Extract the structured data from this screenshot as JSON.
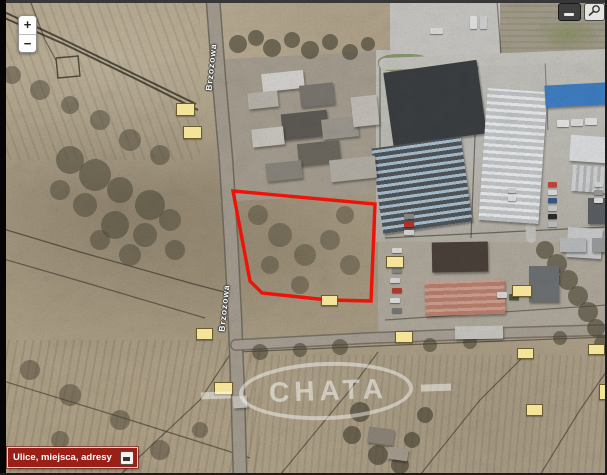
{
  "controls": {
    "zoom_in": "+",
    "zoom_out": "−"
  },
  "search": {
    "placeholder": "Ulice, miejsca, adresy"
  },
  "watermark": {
    "text": "CHATA"
  },
  "street_labels": [
    {
      "text": "Brzozowa"
    },
    {
      "text": "Brzozowa"
    }
  ],
  "map": {
    "selection_color": "#ee1208",
    "selection_polygon": [
      [
        233,
        191
      ],
      [
        375,
        204
      ],
      [
        371,
        301
      ],
      [
        328,
        300
      ],
      [
        262,
        293
      ],
      [
        250,
        281
      ]
    ],
    "marker_style": {
      "bg": "#f3e49a",
      "border": "#6b5d2e"
    },
    "markers": [
      {
        "x": 176,
        "y": 103,
        "w": 17,
        "h": 11
      },
      {
        "x": 183,
        "y": 126,
        "w": 17,
        "h": 11
      },
      {
        "x": 386,
        "y": 256,
        "w": 16,
        "h": 10
      },
      {
        "x": 321,
        "y": 295,
        "w": 15,
        "h": 9
      },
      {
        "x": 395,
        "y": 331,
        "w": 16,
        "h": 10
      },
      {
        "x": 512,
        "y": 285,
        "w": 18,
        "h": 10
      },
      {
        "x": 517,
        "y": 348,
        "w": 15,
        "h": 9
      },
      {
        "x": 526,
        "y": 404,
        "w": 15,
        "h": 10
      },
      {
        "x": 588,
        "y": 344,
        "w": 15,
        "h": 9
      },
      {
        "x": 599,
        "y": 384,
        "w": 8,
        "h": 14
      },
      {
        "x": 214,
        "y": 382,
        "w": 17,
        "h": 11
      },
      {
        "x": 196,
        "y": 328,
        "w": 15,
        "h": 10
      }
    ],
    "buildings": [
      {
        "x": 388,
        "y": 66,
        "w": 94,
        "h": 74,
        "rot": -8,
        "c": "#3b3e41"
      },
      {
        "x": 377,
        "y": 142,
        "w": 90,
        "h": 86,
        "rot": -8,
        "c": "#50555a",
        "s": "#a8bfcf",
        "a": 0
      },
      {
        "x": 483,
        "y": 90,
        "w": 60,
        "h": 132,
        "rot": 4,
        "c": "#c2c5c7",
        "s": "#e9ebec",
        "a": 0
      },
      {
        "x": 545,
        "y": 84,
        "w": 62,
        "h": 22,
        "rot": -3,
        "c": "#3e7ec3"
      },
      {
        "x": 570,
        "y": 136,
        "w": 37,
        "h": 26,
        "rot": 4,
        "c": "#dcdedf"
      },
      {
        "x": 572,
        "y": 166,
        "w": 35,
        "h": 26,
        "rot": 4,
        "c": "#d0d2d3",
        "s": "#b4b6b7",
        "a": 90
      },
      {
        "x": 588,
        "y": 198,
        "w": 19,
        "h": 26,
        "rot": 0,
        "c": "#5c6064"
      },
      {
        "x": 567,
        "y": 228,
        "w": 35,
        "h": 30,
        "rot": 4,
        "c": "#c9cbcc"
      },
      {
        "x": 262,
        "y": 72,
        "w": 42,
        "h": 18,
        "rot": -6,
        "c": "#d6d3cf"
      },
      {
        "x": 300,
        "y": 84,
        "w": 34,
        "h": 22,
        "rot": -6,
        "c": "#7b7670"
      },
      {
        "x": 248,
        "y": 92,
        "w": 30,
        "h": 16,
        "rot": -6,
        "c": "#b9b4ac"
      },
      {
        "x": 282,
        "y": 112,
        "w": 46,
        "h": 26,
        "rot": -6,
        "c": "#5e5a54"
      },
      {
        "x": 322,
        "y": 118,
        "w": 36,
        "h": 20,
        "rot": -6,
        "c": "#9d9890"
      },
      {
        "x": 252,
        "y": 128,
        "w": 32,
        "h": 18,
        "rot": -6,
        "c": "#cac6bf"
      },
      {
        "x": 298,
        "y": 142,
        "w": 42,
        "h": 22,
        "rot": -6,
        "c": "#6c6860"
      },
      {
        "x": 330,
        "y": 158,
        "w": 46,
        "h": 22,
        "rot": -6,
        "c": "#b3afa7"
      },
      {
        "x": 266,
        "y": 162,
        "w": 36,
        "h": 18,
        "rot": -6,
        "c": "#8a867d"
      },
      {
        "x": 352,
        "y": 96,
        "w": 26,
        "h": 30,
        "rot": -6,
        "c": "#c3bfb8"
      },
      {
        "x": 432,
        "y": 242,
        "w": 56,
        "h": 30,
        "rot": -1,
        "c": "#4b403a"
      },
      {
        "x": 425,
        "y": 281,
        "w": 80,
        "h": 34,
        "rot": -2,
        "c": "#b97f6e",
        "s": "#cfa090",
        "a": 0
      },
      {
        "x": 529,
        "y": 266,
        "w": 30,
        "h": 36,
        "rot": 0,
        "c": "#6e7173"
      },
      {
        "x": 455,
        "y": 326,
        "w": 48,
        "h": 13,
        "rot": -1,
        "c": "#c9c7c1"
      },
      {
        "x": 560,
        "y": 238,
        "w": 26,
        "h": 14,
        "rot": 0,
        "c": "#b9bbbc"
      },
      {
        "x": 592,
        "y": 238,
        "w": 15,
        "h": 14,
        "rot": 0,
        "c": "#9a9c9d"
      },
      {
        "x": 368,
        "y": 428,
        "w": 26,
        "h": 16,
        "rot": 8,
        "c": "#8d8579"
      },
      {
        "x": 388,
        "y": 448,
        "w": 20,
        "h": 12,
        "rot": 8,
        "c": "#a79e90"
      },
      {
        "x": 233,
        "y": 396,
        "w": 14,
        "h": 12,
        "rot": -4,
        "c": "#c5c2bb"
      }
    ],
    "cars": [
      {
        "x": 557,
        "y": 120,
        "w": 12,
        "h": 7,
        "c": "#e8e8e8"
      },
      {
        "x": 571,
        "y": 119,
        "w": 12,
        "h": 7,
        "c": "#dedede"
      },
      {
        "x": 585,
        "y": 118,
        "w": 12,
        "h": 7,
        "c": "#e2e2e2"
      },
      {
        "x": 548,
        "y": 182,
        "w": 9,
        "h": 5,
        "c": "#c8453a"
      },
      {
        "x": 548,
        "y": 190,
        "w": 9,
        "h": 5,
        "c": "#dddddd"
      },
      {
        "x": 548,
        "y": 198,
        "w": 9,
        "h": 5,
        "c": "#38588c"
      },
      {
        "x": 548,
        "y": 206,
        "w": 9,
        "h": 5,
        "c": "#cccccc"
      },
      {
        "x": 548,
        "y": 214,
        "w": 9,
        "h": 5,
        "c": "#2a2a2a"
      },
      {
        "x": 548,
        "y": 222,
        "w": 9,
        "h": 5,
        "c": "#bfbfbf"
      },
      {
        "x": 594,
        "y": 182,
        "w": 9,
        "h": 5,
        "c": "#d5d5d5"
      },
      {
        "x": 594,
        "y": 190,
        "w": 9,
        "h": 5,
        "c": "#9a9a9a"
      },
      {
        "x": 594,
        "y": 198,
        "w": 9,
        "h": 5,
        "c": "#e0e0e0"
      },
      {
        "x": 470,
        "y": 16,
        "w": 7,
        "h": 13,
        "c": "#e5e5e5"
      },
      {
        "x": 480,
        "y": 16,
        "w": 7,
        "h": 13,
        "c": "#d2d2d2"
      },
      {
        "x": 430,
        "y": 28,
        "w": 13,
        "h": 6,
        "c": "#dadada"
      },
      {
        "x": 404,
        "y": 214,
        "w": 10,
        "h": 5,
        "c": "#888888"
      },
      {
        "x": 404,
        "y": 222,
        "w": 10,
        "h": 5,
        "c": "#c03028"
      },
      {
        "x": 404,
        "y": 230,
        "w": 10,
        "h": 5,
        "c": "#d8d8d8"
      },
      {
        "x": 392,
        "y": 248,
        "w": 10,
        "h": 5,
        "c": "#dddddd"
      },
      {
        "x": 390,
        "y": 258,
        "w": 10,
        "h": 5,
        "c": "#c0c0c0"
      },
      {
        "x": 392,
        "y": 268,
        "w": 10,
        "h": 5,
        "c": "#8a8a8a"
      },
      {
        "x": 390,
        "y": 278,
        "w": 10,
        "h": 5,
        "c": "#d8d8d8"
      },
      {
        "x": 392,
        "y": 288,
        "w": 10,
        "h": 5,
        "c": "#b23a2e"
      },
      {
        "x": 390,
        "y": 298,
        "w": 10,
        "h": 5,
        "c": "#e0e0e0"
      },
      {
        "x": 392,
        "y": 308,
        "w": 10,
        "h": 5,
        "c": "#777777"
      },
      {
        "x": 508,
        "y": 188,
        "w": 8,
        "h": 5,
        "c": "#d0d0d0"
      },
      {
        "x": 508,
        "y": 196,
        "w": 8,
        "h": 5,
        "c": "#e4e4e4"
      },
      {
        "x": 497,
        "y": 292,
        "w": 10,
        "h": 6,
        "c": "#d8d8d8"
      },
      {
        "x": 509,
        "y": 294,
        "w": 10,
        "h": 6,
        "c": "#445d35"
      }
    ],
    "roads": [
      {
        "pts": "213,0 219,80 226,160 231,240 235,320 238,400 240,475",
        "w": 15,
        "c": "#6e675c",
        "o": 0.9
      },
      {
        "pts": "213,0 219,80 226,160 231,240 235,320 238,400 240,475",
        "w": 12,
        "c": "#a59d90",
        "o": 1
      },
      {
        "pts": "236,345 370,338 500,333 607,330",
        "w": 12,
        "c": "#6e675c",
        "o": 0.8
      },
      {
        "pts": "236,345 370,338 500,333 607,330",
        "w": 9,
        "c": "#a8a094",
        "o": 1
      },
      {
        "pts": "385,64 607,55",
        "w": 12,
        "c": "#c6c4be",
        "o": 1
      },
      {
        "pts": "524,62 528,150 531,238",
        "w": 10,
        "c": "#c4c2bc",
        "o": 1
      }
    ],
    "parcel_lines": [
      {
        "pts": "0,10 60,38 130,72 196,104",
        "w": 2,
        "o": 0.7
      },
      {
        "pts": "0,16 64,44 134,78 198,110",
        "w": 2,
        "o": 0.7
      },
      {
        "pts": "0,228 80,252 190,283 228,293",
        "w": 1.2,
        "o": 0.55
      },
      {
        "pts": "0,258 90,284 205,318",
        "w": 1.2,
        "o": 0.5
      },
      {
        "pts": "0,380 130,420 250,458",
        "w": 1.2,
        "o": 0.5
      },
      {
        "pts": "120,475 200,400 233,350",
        "w": 1.2,
        "o": 0.5
      },
      {
        "pts": "30,0 45,40 56,60",
        "w": 1.2,
        "o": 0.5
      },
      {
        "pts": "56,58 78,56 80,76 58,78 56,58",
        "w": 1.4,
        "o": 0.7
      },
      {
        "pts": "236,352 400,345 607,337",
        "w": 1.2,
        "o": 0.5
      },
      {
        "pts": "280,475 350,390 378,352",
        "w": 1.2,
        "o": 0.5
      },
      {
        "pts": "420,475 480,400 528,352",
        "w": 1.2,
        "o": 0.5
      },
      {
        "pts": "540,475 580,410 606,372",
        "w": 1.2,
        "o": 0.5
      },
      {
        "pts": "385,320 607,305",
        "w": 1.2,
        "o": 0.45
      },
      {
        "pts": "380,210 380,66",
        "w": 1.2,
        "o": 0.5
      },
      {
        "pts": "478,60 471,238",
        "w": 1.2,
        "o": 0.5
      },
      {
        "pts": "385,238 607,227",
        "w": 1.2,
        "o": 0.5
      },
      {
        "pts": "497,0 501,55",
        "w": 1.2,
        "o": 0.45
      },
      {
        "pts": "545,60 548,130",
        "w": 1,
        "o": 0.4
      }
    ],
    "trees": [
      {
        "x": 70,
        "y": 160,
        "r": 14,
        "c": "#4d4837",
        "o": 0.55
      },
      {
        "x": 95,
        "y": 175,
        "r": 16,
        "c": "#4d4837",
        "o": 0.55
      },
      {
        "x": 120,
        "y": 190,
        "r": 13,
        "c": "#4d4837",
        "o": 0.55
      },
      {
        "x": 150,
        "y": 205,
        "r": 15,
        "c": "#4d4837",
        "o": 0.55
      },
      {
        "x": 85,
        "y": 205,
        "r": 12,
        "c": "#4d4837",
        "o": 0.5
      },
      {
        "x": 115,
        "y": 225,
        "r": 14,
        "c": "#4d4837",
        "o": 0.55
      },
      {
        "x": 145,
        "y": 235,
        "r": 12,
        "c": "#4d4837",
        "o": 0.5
      },
      {
        "x": 170,
        "y": 220,
        "r": 11,
        "c": "#4d4837",
        "o": 0.5
      },
      {
        "x": 60,
        "y": 190,
        "r": 10,
        "c": "#4d4837",
        "o": 0.5
      },
      {
        "x": 175,
        "y": 250,
        "r": 10,
        "c": "#4d4837",
        "o": 0.5
      },
      {
        "x": 130,
        "y": 255,
        "r": 11,
        "c": "#4d4837",
        "o": 0.5
      },
      {
        "x": 100,
        "y": 240,
        "r": 10,
        "c": "#4d4837",
        "o": 0.5
      },
      {
        "x": 12,
        "y": 75,
        "r": 9,
        "c": "#4d4837",
        "o": 0.5
      },
      {
        "x": 40,
        "y": 90,
        "r": 10,
        "c": "#4d4837",
        "o": 0.5
      },
      {
        "x": 70,
        "y": 105,
        "r": 9,
        "c": "#4d4837",
        "o": 0.5
      },
      {
        "x": 100,
        "y": 120,
        "r": 10,
        "c": "#4d4837",
        "o": 0.5
      },
      {
        "x": 130,
        "y": 140,
        "r": 11,
        "c": "#4d4837",
        "o": 0.5
      },
      {
        "x": 160,
        "y": 155,
        "r": 10,
        "c": "#4d4837",
        "o": 0.5
      },
      {
        "x": 238,
        "y": 44,
        "r": 9,
        "c": "#43402f",
        "o": 0.6
      },
      {
        "x": 256,
        "y": 38,
        "r": 8,
        "c": "#43402f",
        "o": 0.6
      },
      {
        "x": 272,
        "y": 48,
        "r": 9,
        "c": "#43402f",
        "o": 0.6
      },
      {
        "x": 292,
        "y": 40,
        "r": 8,
        "c": "#43402f",
        "o": 0.6
      },
      {
        "x": 310,
        "y": 50,
        "r": 9,
        "c": "#43402f",
        "o": 0.6
      },
      {
        "x": 330,
        "y": 42,
        "r": 8,
        "c": "#43402f",
        "o": 0.6
      },
      {
        "x": 350,
        "y": 52,
        "r": 8,
        "c": "#43402f",
        "o": 0.6
      },
      {
        "x": 368,
        "y": 44,
        "r": 7,
        "c": "#43402f",
        "o": 0.6
      },
      {
        "x": 258,
        "y": 215,
        "r": 10,
        "c": "#56503e",
        "o": 0.5
      },
      {
        "x": 280,
        "y": 235,
        "r": 12,
        "c": "#56503e",
        "o": 0.5
      },
      {
        "x": 305,
        "y": 255,
        "r": 11,
        "c": "#56503e",
        "o": 0.5
      },
      {
        "x": 330,
        "y": 240,
        "r": 10,
        "c": "#56503e",
        "o": 0.5
      },
      {
        "x": 350,
        "y": 265,
        "r": 10,
        "c": "#56503e",
        "o": 0.5
      },
      {
        "x": 300,
        "y": 285,
        "r": 9,
        "c": "#56503e",
        "o": 0.5
      },
      {
        "x": 270,
        "y": 265,
        "r": 9,
        "c": "#56503e",
        "o": 0.5
      },
      {
        "x": 345,
        "y": 215,
        "r": 9,
        "c": "#56503e",
        "o": 0.5
      },
      {
        "x": 545,
        "y": 250,
        "r": 9,
        "c": "#474330",
        "o": 0.6
      },
      {
        "x": 557,
        "y": 264,
        "r": 10,
        "c": "#474330",
        "o": 0.6
      },
      {
        "x": 568,
        "y": 280,
        "r": 10,
        "c": "#474330",
        "o": 0.6
      },
      {
        "x": 578,
        "y": 296,
        "r": 10,
        "c": "#474330",
        "o": 0.6
      },
      {
        "x": 588,
        "y": 312,
        "r": 10,
        "c": "#474330",
        "o": 0.6
      },
      {
        "x": 596,
        "y": 328,
        "r": 9,
        "c": "#474330",
        "o": 0.6
      },
      {
        "x": 603,
        "y": 344,
        "r": 9,
        "c": "#474330",
        "o": 0.6
      },
      {
        "x": 260,
        "y": 352,
        "r": 8,
        "c": "#45412f",
        "o": 0.55
      },
      {
        "x": 300,
        "y": 350,
        "r": 7,
        "c": "#45412f",
        "o": 0.55
      },
      {
        "x": 340,
        "y": 347,
        "r": 8,
        "c": "#45412f",
        "o": 0.55
      },
      {
        "x": 430,
        "y": 345,
        "r": 7,
        "c": "#45412f",
        "o": 0.55
      },
      {
        "x": 470,
        "y": 342,
        "r": 7,
        "c": "#45412f",
        "o": 0.55
      },
      {
        "x": 560,
        "y": 338,
        "r": 7,
        "c": "#45412f",
        "o": 0.55
      },
      {
        "x": 30,
        "y": 370,
        "r": 10,
        "c": "#4d4837",
        "o": 0.5
      },
      {
        "x": 70,
        "y": 395,
        "r": 11,
        "c": "#4d4837",
        "o": 0.5
      },
      {
        "x": 120,
        "y": 420,
        "r": 10,
        "c": "#4d4837",
        "o": 0.5
      },
      {
        "x": 60,
        "y": 440,
        "r": 9,
        "c": "#4d4837",
        "o": 0.5
      },
      {
        "x": 160,
        "y": 450,
        "r": 10,
        "c": "#4d4837",
        "o": 0.5
      },
      {
        "x": 20,
        "y": 460,
        "r": 9,
        "c": "#4d4837",
        "o": 0.5
      },
      {
        "x": 200,
        "y": 430,
        "r": 8,
        "c": "#4d4837",
        "o": 0.5
      },
      {
        "x": 360,
        "y": 412,
        "r": 10,
        "c": "#3f3b2c",
        "o": 0.6
      },
      {
        "x": 352,
        "y": 435,
        "r": 9,
        "c": "#3f3b2c",
        "o": 0.6
      },
      {
        "x": 378,
        "y": 455,
        "r": 10,
        "c": "#3f3b2c",
        "o": 0.6
      },
      {
        "x": 400,
        "y": 465,
        "r": 9,
        "c": "#3f3b2c",
        "o": 0.6
      },
      {
        "x": 412,
        "y": 440,
        "r": 8,
        "c": "#3f3b2c",
        "o": 0.6
      },
      {
        "x": 425,
        "y": 415,
        "r": 8,
        "c": "#3f3b2c",
        "o": 0.6
      }
    ]
  }
}
